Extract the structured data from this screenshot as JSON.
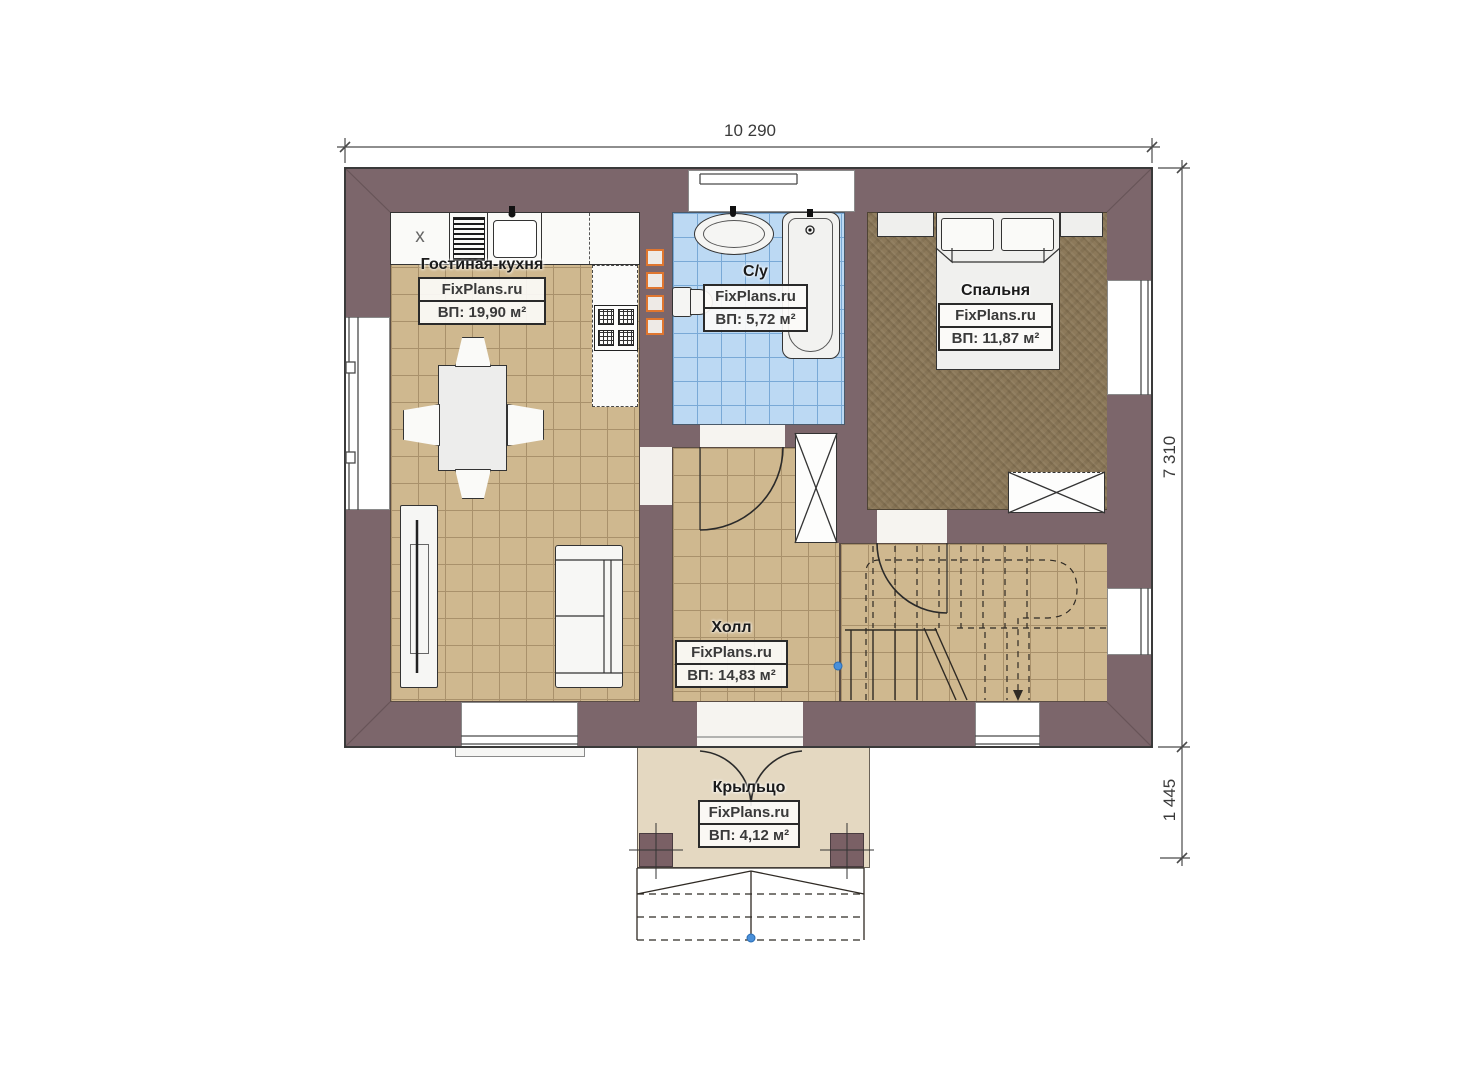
{
  "dimensions": {
    "width_total": "10 290",
    "height_main": "7 310",
    "height_porch": "1 445"
  },
  "rooms": {
    "living": {
      "name": "Гостиная-кухня",
      "watermark": "FixPlans.ru",
      "area": "ВП: 19,90 м²"
    },
    "bathroom": {
      "name": "С/у",
      "watermark": "FixPlans.ru",
      "area": "ВП: 5,72 м²"
    },
    "bedroom": {
      "name": "Спальня",
      "watermark": "FixPlans.ru",
      "area": "ВП: 11,87 м²"
    },
    "hall": {
      "name": "Холл",
      "watermark": "FixPlans.ru",
      "area": "ВП: 14,83 м²"
    },
    "porch": {
      "name": "Крыльцо",
      "watermark": "FixPlans.ru",
      "area": "ВП: 4,12 м²"
    }
  },
  "kitchen": {
    "appliance_mark": "x"
  },
  "colors": {
    "wall": "#7c666b",
    "tile_floor": "#cfb88f",
    "tile_grout": "#a9916b",
    "bath_tile": "#bcd9f3",
    "bath_grout": "#79a9d6",
    "bedroom_carpet": "#8c795a",
    "porch_floor": "#e4d8c1",
    "vent_accent": "#e0762f",
    "line": "#2e2a26"
  }
}
